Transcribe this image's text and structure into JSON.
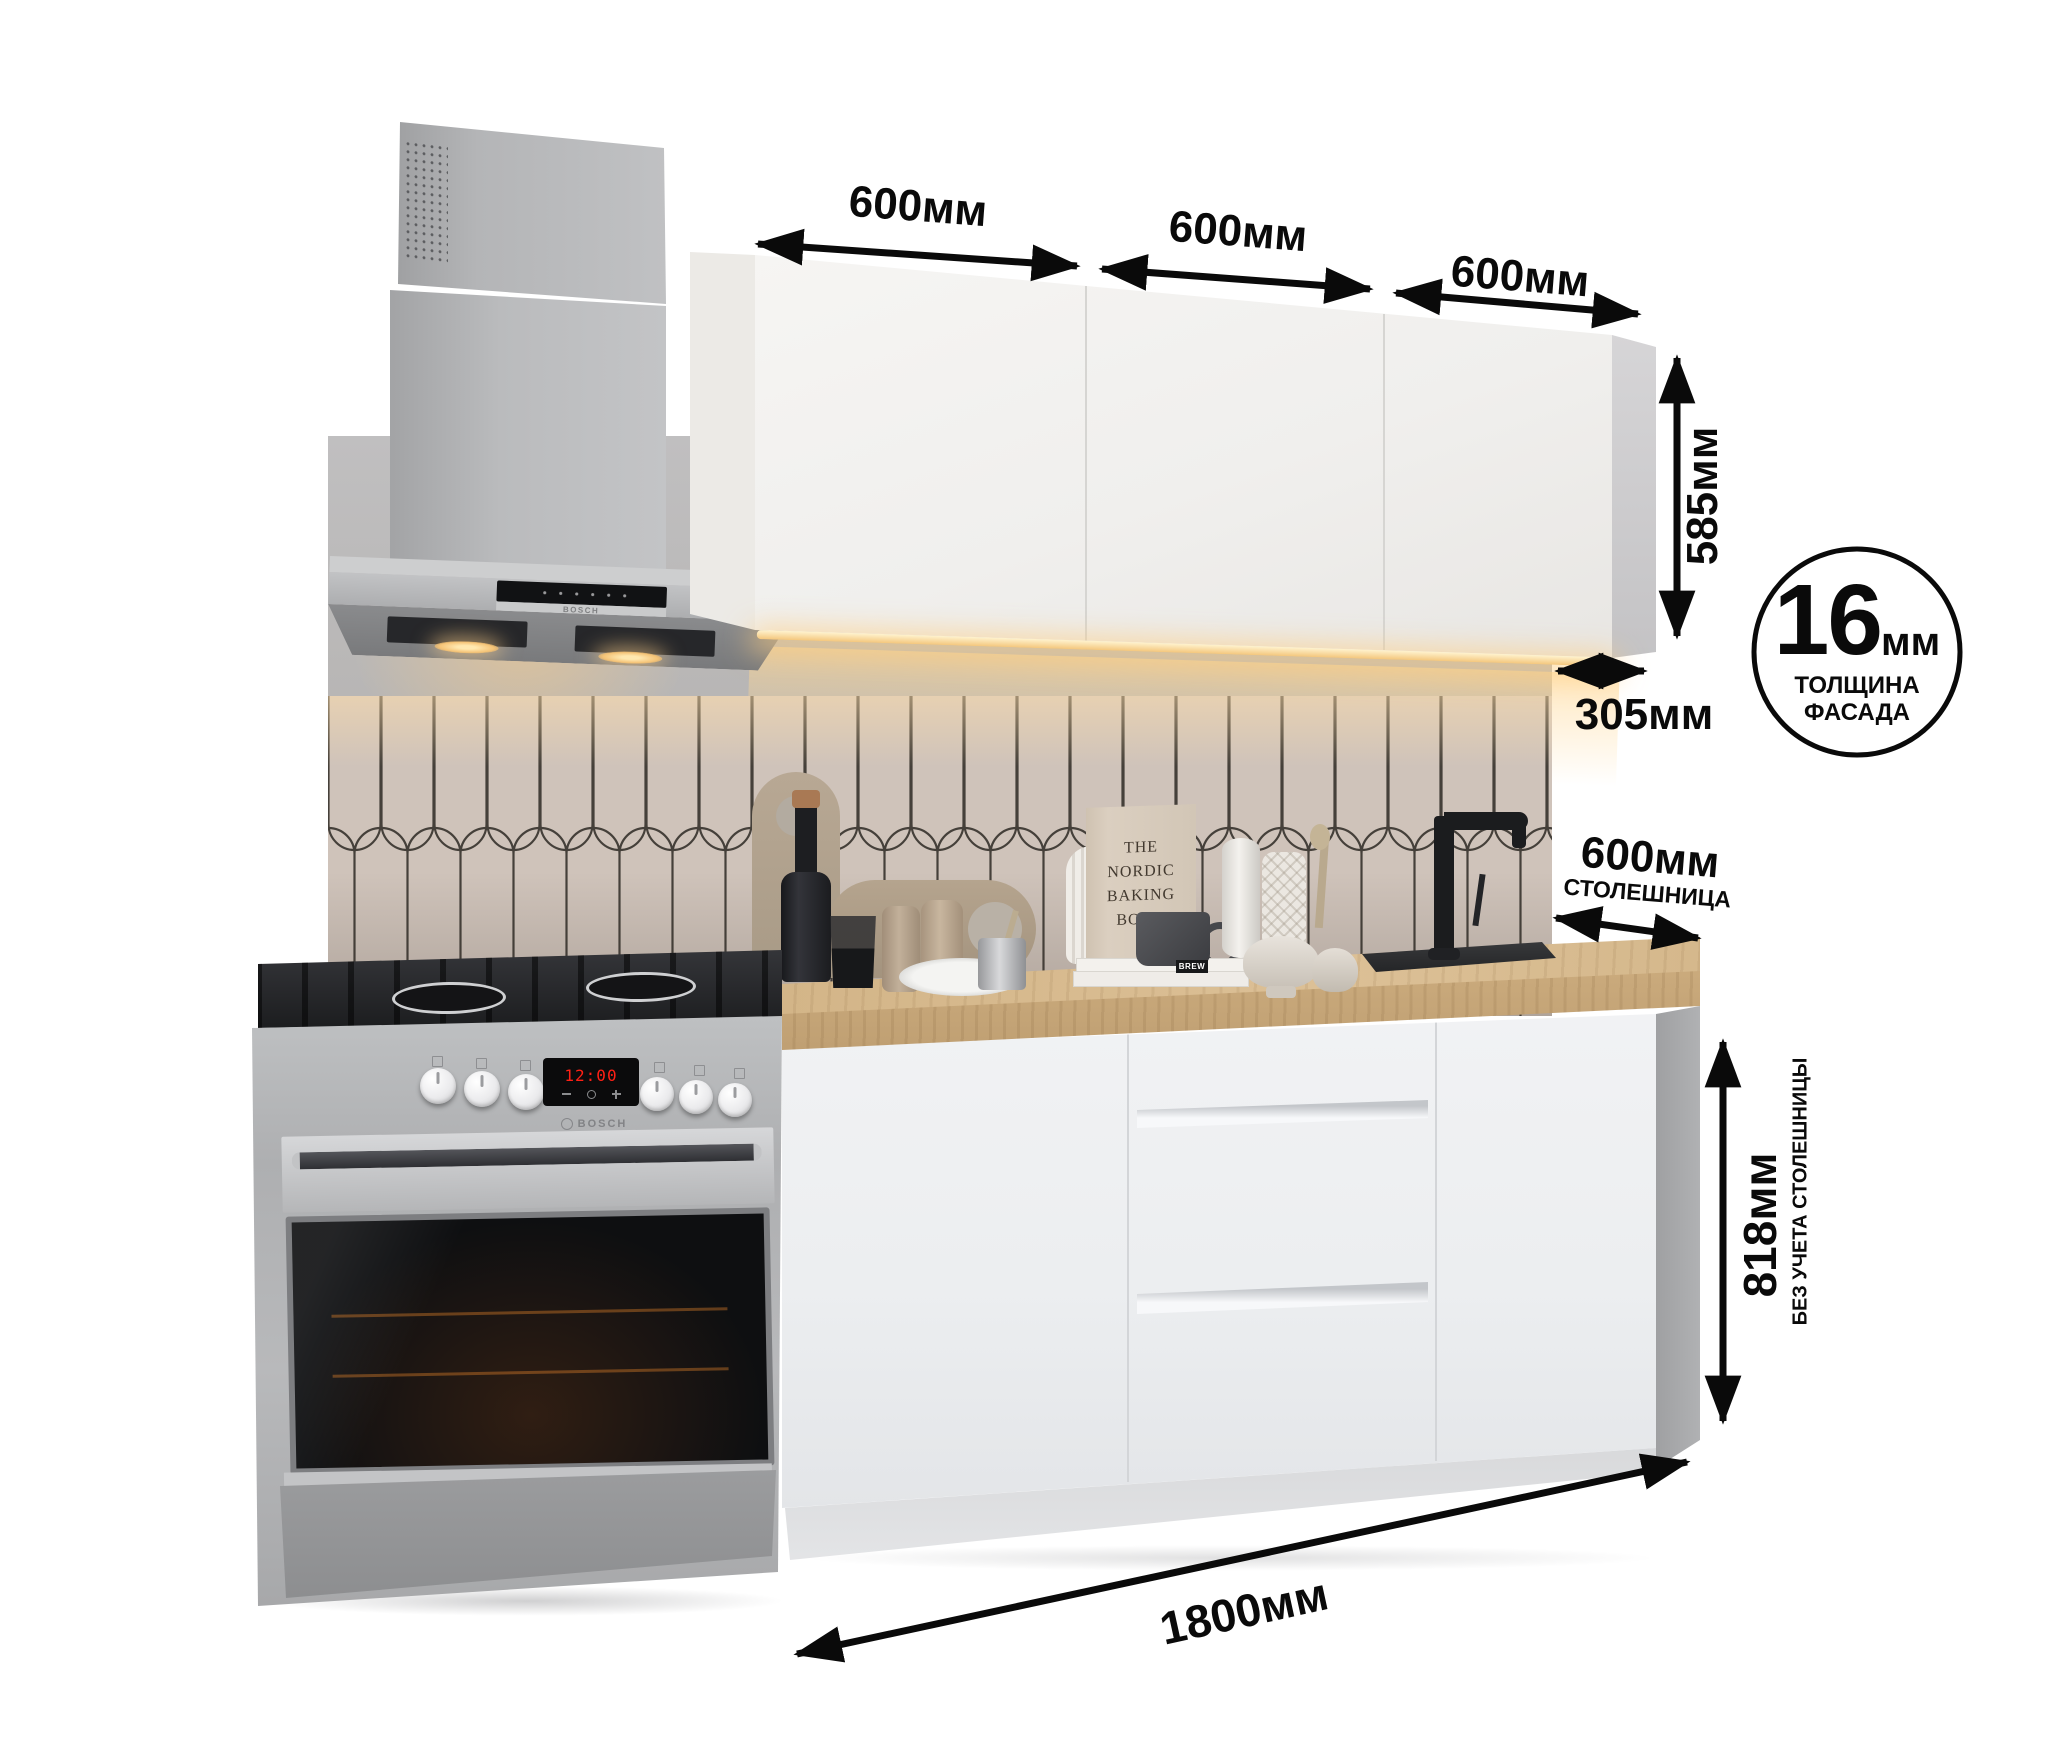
{
  "dimensions": {
    "upper_cabinets": [
      "600мм",
      "600мм",
      "600мм"
    ],
    "upper_height": "585мм",
    "upper_depth": "305мм",
    "facade_badge": {
      "value": "16",
      "unit": "мм",
      "caption_line1": "ТОЛЩИНА",
      "caption_line2": "ФАСАДА"
    },
    "countertop": {
      "value": "600мм",
      "caption": "СТОЛЕШНИЦА"
    },
    "base_height": {
      "value": "818мм",
      "caption": "БЕЗ УЧЕТА СТОЛЕШНИЦЫ"
    },
    "total_width": "1800мм"
  },
  "appliances": {
    "hood_brand": "BOSCH",
    "stove_brand": "BOSCH",
    "stove_clock": "12:00"
  },
  "decor": {
    "book_line1": "THE",
    "book_line2": "NORDIC",
    "book_line3": "BAKING",
    "book_line4": "BOOK",
    "book_spine": "BREW"
  },
  "colors": {
    "annotation": "#0a0a0a",
    "wall": "#b4b2b0",
    "tile": "#cfc3ba",
    "tile_line": "#45403a",
    "upper_cabinet_front": "#f2f1ef",
    "base_cabinet_front": "#edeff1",
    "countertop_wood": "#d2b489",
    "hood_steel": "#b3b4b6",
    "led_light": "#ffd98f",
    "display_red": "#ff2015"
  }
}
